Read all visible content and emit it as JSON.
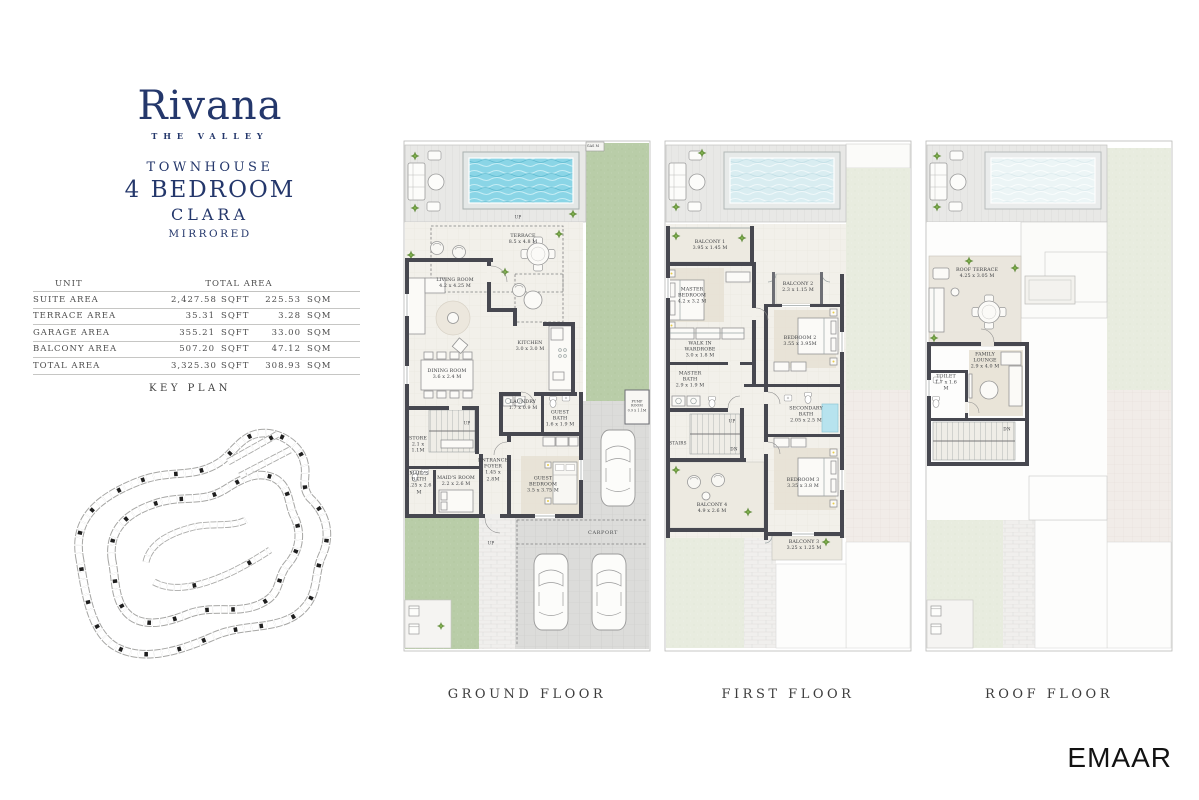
{
  "brand": {
    "logo_text": "Rivana",
    "tagline": "THE VALLEY",
    "line1": "TOWNHOUSE",
    "line2": "4 BEDROOM",
    "line3": "CLARA",
    "line4": "MIRRORED",
    "navy": "#24376b",
    "pool_color": "#8ad5e6"
  },
  "area_table": {
    "header_unit": "UNIT",
    "header_total": "TOTAL AREA",
    "rows": [
      {
        "label": "SUITE AREA",
        "sqft": "2,427.58",
        "sqft_unit": "SQFT",
        "sqm": "225.53",
        "sqm_unit": "SQM"
      },
      {
        "label": "TERRACE AREA",
        "sqft": "35.31",
        "sqft_unit": "SQFT",
        "sqm": "3.28",
        "sqm_unit": "SQM"
      },
      {
        "label": "GARAGE AREA",
        "sqft": "355.21",
        "sqft_unit": "SQFT",
        "sqm": "33.00",
        "sqm_unit": "SQM"
      },
      {
        "label": "BALCONY AREA",
        "sqft": "507.20",
        "sqft_unit": "SQFT",
        "sqm": "47.12",
        "sqm_unit": "SQM"
      },
      {
        "label": "TOTAL AREA",
        "sqft": "3,325.30",
        "sqft_unit": "SQFT",
        "sqm": "308.93",
        "sqm_unit": "SQM"
      }
    ]
  },
  "key_plan": {
    "title": "KEY PLAN"
  },
  "floors": {
    "ground": {
      "caption": "GROUND FLOOR",
      "rooms": {
        "terrace": {
          "name": "TERRACE",
          "dims": "8.5 x 4.8 M"
        },
        "living": {
          "name": "LIVING ROOM",
          "dims": "4.2 x 4.25 M"
        },
        "dining": {
          "name": "DINING ROOM",
          "dims": "3.6 x 2.4 M"
        },
        "kitchen": {
          "name": "KITCHEN",
          "dims": "3.0 x 3.0 M"
        },
        "laundry": {
          "name": "LAUNDRY",
          "dims": "1.7 x 0.9 M"
        },
        "guest_bath": {
          "name": "GUEST BATH",
          "dims": "1.6 x 1.9 M"
        },
        "store": {
          "name": "STORE",
          "dims": "2.1 x 1.1M"
        },
        "maids_bath": {
          "name": "MAID'S BATH",
          "dims": "1.25 x 2.6 M"
        },
        "maids_room": {
          "name": "MAID'S ROOM",
          "dims": "2.2 x 2.6 M"
        },
        "foyer": {
          "name": "ENTRANCE FOYER",
          "dims": "1.45 x 2.8M"
        },
        "guest_bedroom": {
          "name": "GUEST BEDROOM",
          "dims": "3.5 x 3.75 M"
        },
        "pump": {
          "name": "PUMP ROOM",
          "dims": "0.9 x 1.1M"
        },
        "carport": {
          "name": "CARPORT"
        },
        "gas": {
          "name": "GAS M"
        },
        "up_deck": {
          "name": "UP"
        },
        "up_stairs": {
          "name": "UP"
        },
        "up_path": {
          "name": "UP"
        }
      }
    },
    "first": {
      "caption": "FIRST FLOOR",
      "rooms": {
        "balcony1": {
          "name": "BALCONY 1",
          "dims": "3.95 x 1.45 M"
        },
        "master_bedroom": {
          "name": "MASTER BEDROOM",
          "dims": "4.2 x 3.2 M"
        },
        "balcony2": {
          "name": "BALCONY 2",
          "dims": "2.3 x 1.15 M"
        },
        "bedroom2": {
          "name": "BEDROOM 2",
          "dims": "3.55 x 3.95M"
        },
        "wardrobe": {
          "name": "WALK IN WARDROBE",
          "dims": "3.0 x 1.8 M"
        },
        "master_bath": {
          "name": "MASTER BATH",
          "dims": "2.9 x 1.9 M"
        },
        "stairs": {
          "name": "STAIRS"
        },
        "up": {
          "name": "UP"
        },
        "dn": {
          "name": "DN"
        },
        "secondary_bath": {
          "name": "SECONDARY BATH",
          "dims": "2.05 x 2.5 M"
        },
        "bedroom3": {
          "name": "BEDROOM 3",
          "dims": "3.35 x 3.8 M"
        },
        "balcony4": {
          "name": "BALCONY 4",
          "dims": "4.9 x 2.6 M"
        },
        "balcony3": {
          "name": "BALCONY 3",
          "dims": "3.25 x 1.25 M"
        }
      }
    },
    "roof": {
      "caption": "ROOF FLOOR",
      "rooms": {
        "roof_terrace": {
          "name": "ROOF TERRACE",
          "dims": "4.25 x 3.05 M"
        },
        "family_lounge": {
          "name": "FAMILY LOUNGE",
          "dims": "2.9 x 4.0 M"
        },
        "toilet": {
          "name": "TOILET",
          "dims": "1.7 x 1.6 M"
        },
        "dn": {
          "name": "DN"
        }
      }
    }
  },
  "footer": {
    "logo": "EMAAR"
  }
}
